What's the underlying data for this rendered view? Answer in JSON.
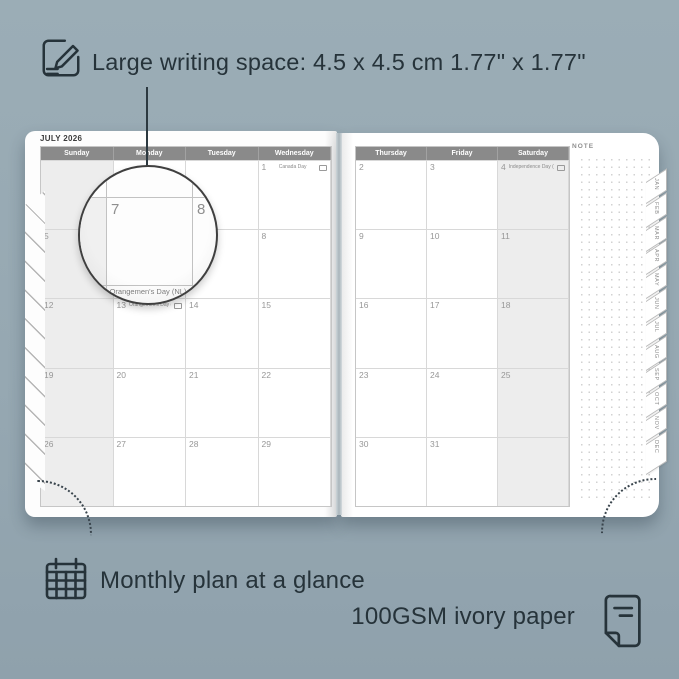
{
  "annotations": {
    "top": {
      "icon": "pencil-note-icon",
      "text": "Large writing space: 4.5 x 4.5 cm  1.77\" x 1.77\""
    },
    "bottom_left": {
      "icon": "calendar-icon",
      "text": "Monthly plan at a glance"
    },
    "bottom_right": {
      "icon": "paper-icon",
      "text": "100GSM ivory paper"
    }
  },
  "planner": {
    "month_title": "JULY 2026",
    "note_label": "NOTE",
    "left_page": {
      "day_headers": [
        "Sunday",
        "Monday",
        "Tuesday",
        "Wednesday"
      ],
      "rows": [
        [
          {
            "d": ""
          },
          {
            "d": ""
          },
          {
            "d": ""
          },
          {
            "d": "1",
            "label": "Canada Day"
          }
        ],
        [
          {
            "d": "5"
          },
          {
            "d": "6"
          },
          {
            "d": "7"
          },
          {
            "d": "8"
          }
        ],
        [
          {
            "d": "12"
          },
          {
            "d": "13",
            "label": "Orangemen's Day (NL)"
          },
          {
            "d": "14"
          },
          {
            "d": "15"
          }
        ],
        [
          {
            "d": "19"
          },
          {
            "d": "20"
          },
          {
            "d": "21"
          },
          {
            "d": "22"
          }
        ],
        [
          {
            "d": "26"
          },
          {
            "d": "27"
          },
          {
            "d": "28"
          },
          {
            "d": "29"
          }
        ]
      ]
    },
    "right_page": {
      "day_headers": [
        "Thursday",
        "Friday",
        "Saturday"
      ],
      "rows": [
        [
          {
            "d": "2"
          },
          {
            "d": "3"
          },
          {
            "d": "4",
            "label": "Independence Day (US)"
          }
        ],
        [
          {
            "d": "9"
          },
          {
            "d": "10"
          },
          {
            "d": "11"
          }
        ],
        [
          {
            "d": "16"
          },
          {
            "d": "17"
          },
          {
            "d": "18"
          }
        ],
        [
          {
            "d": "23"
          },
          {
            "d": "24"
          },
          {
            "d": "25"
          }
        ],
        [
          {
            "d": "30"
          },
          {
            "d": "31"
          },
          {
            "d": ""
          }
        ]
      ]
    },
    "month_tabs": [
      "JAN",
      "FEB",
      "MAR",
      "APR",
      "MAY",
      "JUN",
      "JUL",
      "AUG",
      "SEP",
      "OCT",
      "NOV",
      "DEC"
    ],
    "magnifier": {
      "day": "7",
      "next_day": "8",
      "bottom_label": "Orangemen's Day (NL)"
    }
  },
  "colors": {
    "background": "#96a8b2",
    "ink": "#26333a",
    "header_gray": "#8a8a8a",
    "weekend_fill": "#ededed",
    "page_white": "#ffffff",
    "grid_line": "#d8d8d8"
  }
}
